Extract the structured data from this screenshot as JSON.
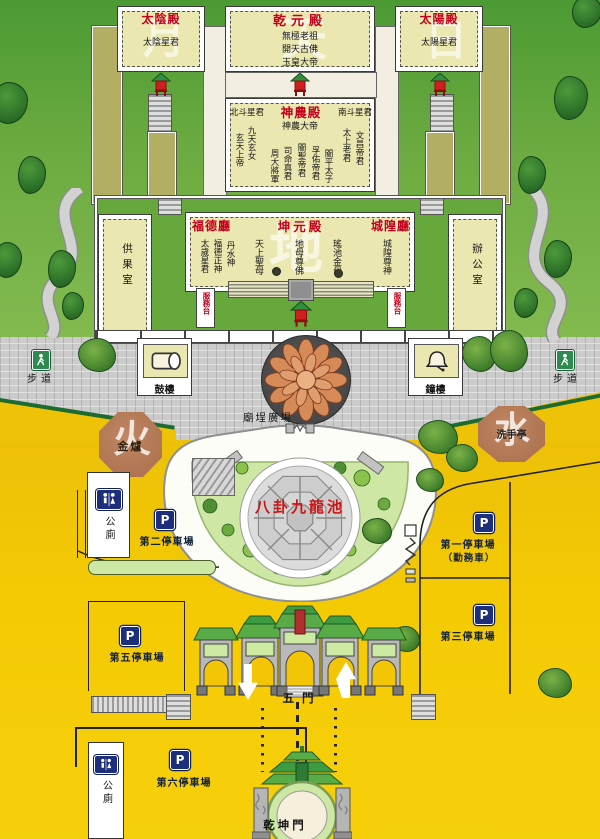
{
  "colors": {
    "red_label": "#c2001c",
    "parking_blue": "#1d2e7d",
    "roof_green": "#3e9b41",
    "bg_green": "#66a83f",
    "bg_yellow": "#f2c607",
    "plaza_gray": "#cccccc",
    "hall_cream": "#ebe7b0",
    "octagon_brown": "#b5795a",
    "pond_green": "#cfe7a4"
  },
  "halls": {
    "taiyin": {
      "title": "太陰殿",
      "deity": "太陰星君",
      "watermark": "月"
    },
    "qianyuan": {
      "title": "乾元殿",
      "deity1": "無極老祖",
      "deity2": "開天古佛",
      "deity3": "玉皇大帝",
      "watermark": "天"
    },
    "taiyang": {
      "title": "太陽殿",
      "deity": "太陽星君",
      "watermark": "日"
    },
    "shennong": {
      "title": "神農殿",
      "north": "北斗星君",
      "south": "南斗星君",
      "main": "神農大帝",
      "left1": "玄天上帝",
      "left2": "九天玄女",
      "c1": "周大將軍",
      "c2": "司命真君",
      "c3": "關聖帝君",
      "c4": "孚佑帝君",
      "c5": "關平太子",
      "right1": "太上老君",
      "right2": "文昌帝君"
    },
    "kunyuan": {
      "title_left": "福德廳",
      "title": "坤元殿",
      "title_right": "城隍廳",
      "watermark": "地",
      "left1": "太歲星君",
      "left2": "福德正神",
      "left3": "丹水神",
      "center1": "天上聖母",
      "center2": "地母尊佛",
      "center3": "瑤池金母",
      "right1": "城隍尊神",
      "service_desk": "服務台"
    },
    "offering_room": "供果室",
    "office": "辦公室"
  },
  "plaza": {
    "drum_tower": "鼓樓",
    "bell_tower": "鐘樓",
    "square": "廟埕廣場",
    "walkway": "步道",
    "gold_furnace": "金爐",
    "fire_mark": "火",
    "wash_pavilion": "洗手亭",
    "water_mark": "水"
  },
  "pond": {
    "label": "八卦九龍池"
  },
  "parking": {
    "symbol": "P",
    "lot1": "第一停車場",
    "lot1_note": "（勤務車）",
    "lot2": "第二停車場",
    "lot3": "第三停車場",
    "lot5": "第五停車場",
    "lot6": "第六停車場"
  },
  "facilities": {
    "toilet": "公廁"
  },
  "gates": {
    "five_gate": "五門",
    "qiankun_gate": "乾坤門"
  }
}
